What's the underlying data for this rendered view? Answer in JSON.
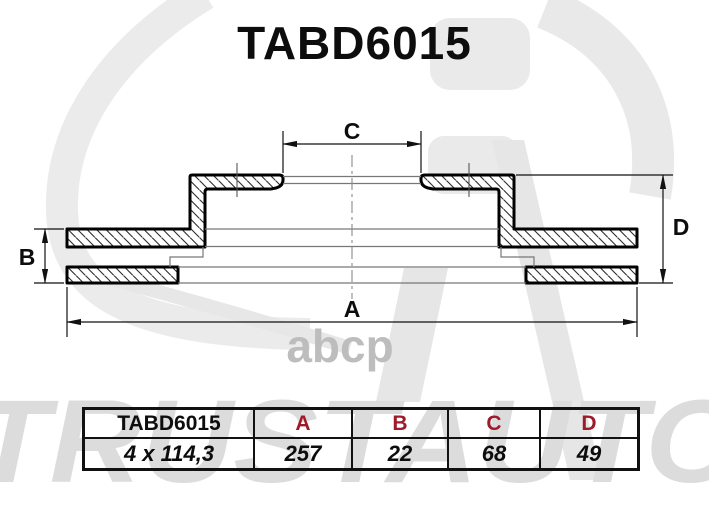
{
  "title": "TABD6015",
  "dims": {
    "a": "A",
    "b": "B",
    "c": "C",
    "d": "D"
  },
  "table": {
    "header": {
      "part": "TABD6015",
      "a": "A",
      "b": "B",
      "c": "C",
      "d": "D"
    },
    "values": {
      "bolt_pattern": "4 x 114,3",
      "a": "257",
      "b": "22",
      "c": "68",
      "d": "49"
    }
  },
  "watermarks": {
    "brand": "TRUSTAUTO",
    "abcp": "abcp"
  },
  "colors": {
    "header_red": "#9e1b29",
    "line": "#000000",
    "watermark_gray": "#e9e9e9"
  }
}
